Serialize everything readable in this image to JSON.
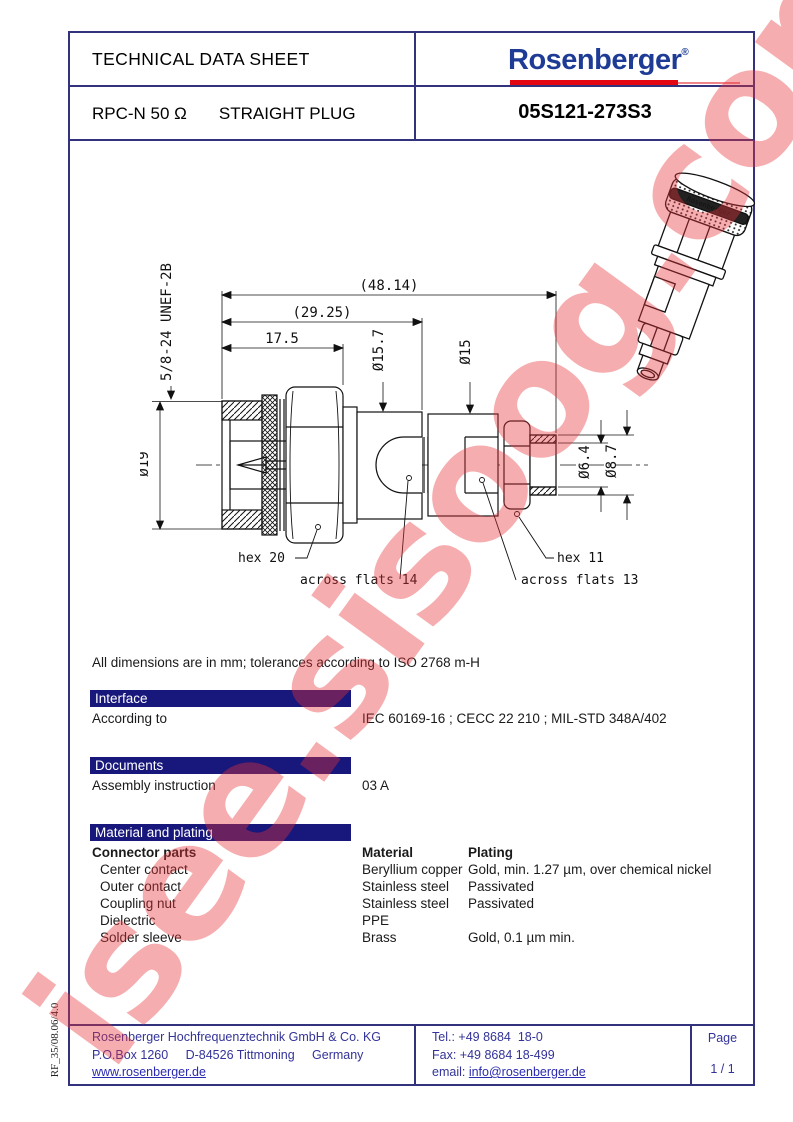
{
  "watermark": {
    "text": "isee.sisoog.com"
  },
  "side_note": "RF_35/08.06/4.0",
  "header": {
    "title": "TECHNICAL DATA SHEET",
    "logo": {
      "text": "Rosenberger",
      "registered": "®"
    },
    "product_line1": "RPC-N 50 Ω",
    "product_line2": "STRAIGHT PLUG",
    "part_number": "05S121-273S3",
    "accent_blue": "#1e3c96",
    "accent_red": "#e30613",
    "bar_blue": "#17177c"
  },
  "drawing": {
    "thread_label": "5/8-24 UNEF-2B",
    "dims": {
      "overall_length": "(48.14)",
      "mid_length": "(29.25)",
      "front_length": "17.5",
      "dia19": "Ø19",
      "dia15_7": "Ø15.7",
      "dia15": "Ø15",
      "dia6_4": "Ø6.4",
      "dia8_7": "Ø8.7"
    },
    "callouts": {
      "hex20": "hex 20",
      "across_flats_14": "across flats 14",
      "hex11": "hex 11",
      "across_flats_13": "across flats 13"
    },
    "photo_brand": "Rosenberger"
  },
  "notes": {
    "dimensions_note": "All dimensions are in mm; tolerances according to ISO 2768 m-H"
  },
  "sections": {
    "interface": {
      "title": "Interface",
      "row_label": "According to",
      "row_value": "IEC 60169-16 ; CECC 22 210 ; MIL-STD 348A/402"
    },
    "documents": {
      "title": "Documents",
      "row_label": "Assembly instruction",
      "row_value": "03 A"
    },
    "material": {
      "title": "Material and plating",
      "col1": "Connector parts",
      "col2": "Material",
      "col3": "Plating",
      "rows": [
        {
          "part": "Center contact",
          "material": "Beryllium copper",
          "plating": "Gold, min. 1.27 µm, over chemical nickel"
        },
        {
          "part": "Outer contact",
          "material": "Stainless steel",
          "plating": "Passivated"
        },
        {
          "part": "Coupling nut",
          "material": "Stainless steel",
          "plating": "Passivated"
        },
        {
          "part": "Dielectric",
          "material": "PPE",
          "plating": ""
        },
        {
          "part": "Solder sleeve",
          "material": "Brass",
          "plating": "Gold, 0.1 µm min."
        }
      ]
    }
  },
  "footer": {
    "company": "Rosenberger Hochfrequenztechnik GmbH & Co. KG",
    "address": "P.O.Box 1260     D-84526 Tittmoning     Germany",
    "website": "www.rosenberger.de",
    "tel": "Tel.: +49 8684  18-0",
    "fax": "Fax: +49 8684 18-499",
    "email_label": "email: ",
    "email": "info@rosenberger.de",
    "page_label": "Page",
    "page_value": "1 / 1"
  }
}
